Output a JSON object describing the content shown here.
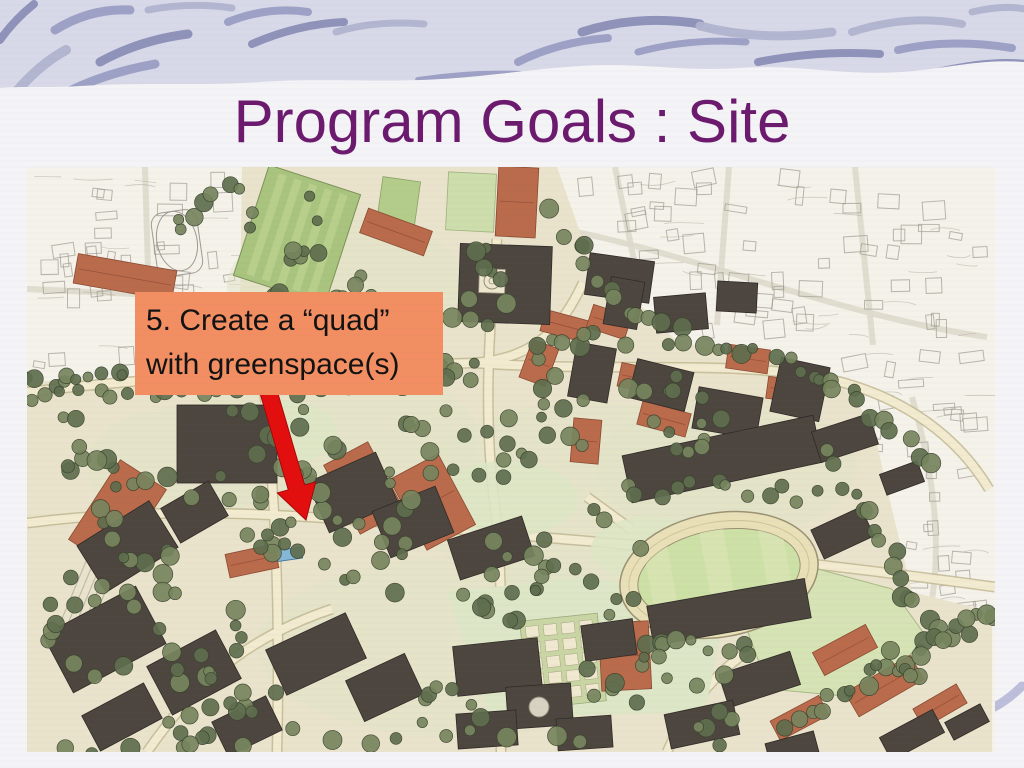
{
  "slide": {
    "title": "Program Goals : Site"
  },
  "theme": {
    "title_color": "#6B1A6E",
    "slide_background": "#f4f3f6",
    "band_background": "#d8d9e8",
    "band_stroke_colors": [
      "#9b9ec4",
      "#8b8eb6",
      "#b1b4cf"
    ],
    "swirl_accent": "#bdbeda"
  },
  "callout": {
    "lines": [
      "5. Create a “quad”",
      "with greenspace(s)"
    ],
    "background_color": "#F28E62",
    "text_color": "#121212"
  },
  "arrow": {
    "color": "#E30E0E"
  },
  "map": {
    "description": "Hand-drawn aerial site plan of a campus with dark and terracotta buildings, tree allees, green playing fields, an oval running track, and sketched neighborhood blocks around the edges",
    "palette": {
      "paper": "#f4f2e9",
      "ground": "#eae3cb",
      "ground_wash": "#dfe3c6",
      "lawn": "#d6e3b4",
      "lawn_light": "#dde6c6",
      "field_green": "#a9c47e",
      "field_stripe": "#bcd290",
      "tree_dark": "#5f6e4e",
      "tree_mid": "#77855e",
      "building_dark": "#4d463f",
      "building_terracotta": "#b96b4b",
      "path_cream": "#f2ebd0",
      "path_edge": "#c2b893",
      "track_ring": "#e9e0b8",
      "track_infield": "#cde0a6",
      "pool_blue": "#85b7d8",
      "sketch_line": "#a09a90"
    }
  }
}
